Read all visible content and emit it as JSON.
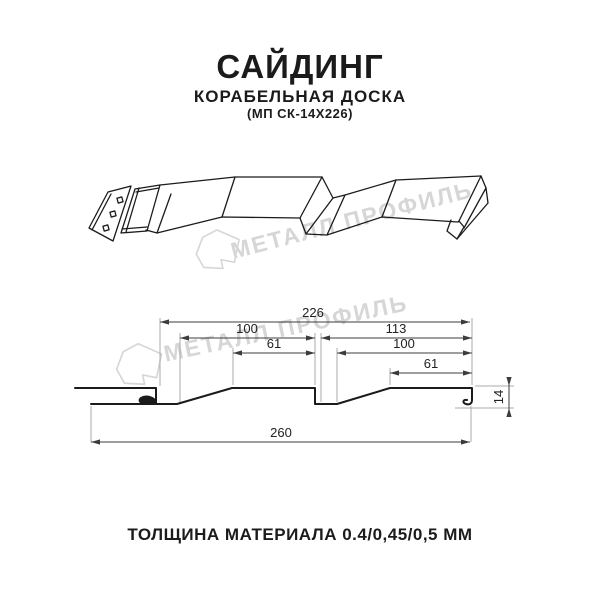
{
  "header": {
    "title": "САЙДИНГ",
    "subtitle": "КОРАБЕЛЬНАЯ ДОСКА",
    "product_code": "(МП СК-14Х226)"
  },
  "watermark": {
    "brand": "МЕТАЛЛ ПРОФИЛЬ",
    "color": "#d6d6d6"
  },
  "dimensions_mm": {
    "profile_width": "226",
    "wave1_top": "100",
    "wave1_slope": "61",
    "wave2_top": "113",
    "wave2_inner": "100",
    "wave2_slope": "61",
    "overall_width": "260",
    "profile_height": "14"
  },
  "footer": {
    "thickness_note": "ТОЛЩИНА МАТЕРИАЛА 0.4/0,45/0,5 ММ"
  },
  "colors": {
    "line": "#1b1b1b",
    "dimension": "#3c3c3c",
    "extension": "#ababab",
    "watermark": "#d6d6d6"
  }
}
